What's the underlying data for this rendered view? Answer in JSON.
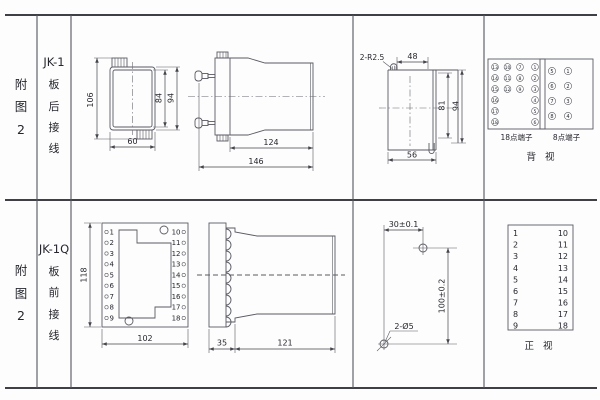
{
  "colors": {
    "background": "#fdfdfd",
    "grid_line": "#3f4046",
    "drawing_line": "#5a5b63",
    "text": "#26272e"
  },
  "row1": {
    "fig_label": "附\n图\n2",
    "model": "JK-1",
    "wiring": "板\n后\n接\n线",
    "front_view": {
      "dim_height_overall": "106",
      "dim_height_inner": "84",
      "dim_height_case": "94",
      "dim_width": "60"
    },
    "side_view": {
      "dim_body_length": "124",
      "dim_total_length": "146"
    },
    "cutout": {
      "corner_note": "2-R2.5",
      "dim_top": "48",
      "dim_height_inner": "81",
      "dim_height_outer": "94",
      "dim_width": "56"
    },
    "terminals_18": {
      "label": "18点端子",
      "col1": [
        "13",
        "14",
        "15",
        "16",
        "17",
        "18"
      ],
      "col2": [
        "10",
        "11",
        "12"
      ],
      "col3": [
        "7",
        "8",
        "9"
      ],
      "col4": [
        "1",
        "2",
        "3",
        "4",
        "5",
        "6"
      ]
    },
    "terminals_8": {
      "label": "8点端子",
      "col1": [
        "5",
        "6",
        "7",
        "8"
      ],
      "col2": [
        "1",
        "2",
        "3",
        "4"
      ]
    },
    "view_label": "背  视"
  },
  "row2": {
    "fig_label": "附\n图\n2",
    "model": "JK-1Q",
    "wiring": "板\n前\n接\n线",
    "front_view": {
      "dim_height": "118",
      "dim_width": "102",
      "left_terminals": [
        "1",
        "2",
        "3",
        "4",
        "5",
        "6",
        "7",
        "8",
        "9"
      ],
      "right_terminals": [
        "10",
        "11",
        "12",
        "13",
        "14",
        "15",
        "16",
        "17",
        "18"
      ]
    },
    "side_view": {
      "dim_flange": "35",
      "dim_body_length": "121"
    },
    "drill_plan": {
      "dim_hole_span": "30±0.1",
      "dim_hole_height": "100±0.2",
      "hole_note": "2-Ø5"
    },
    "terminal_table": {
      "left": [
        "1",
        "2",
        "3",
        "4",
        "5",
        "6",
        "7",
        "8",
        "9"
      ],
      "right": [
        "10",
        "11",
        "12",
        "13",
        "14",
        "15",
        "16",
        "17",
        "18"
      ],
      "view_label": "正  视"
    }
  }
}
